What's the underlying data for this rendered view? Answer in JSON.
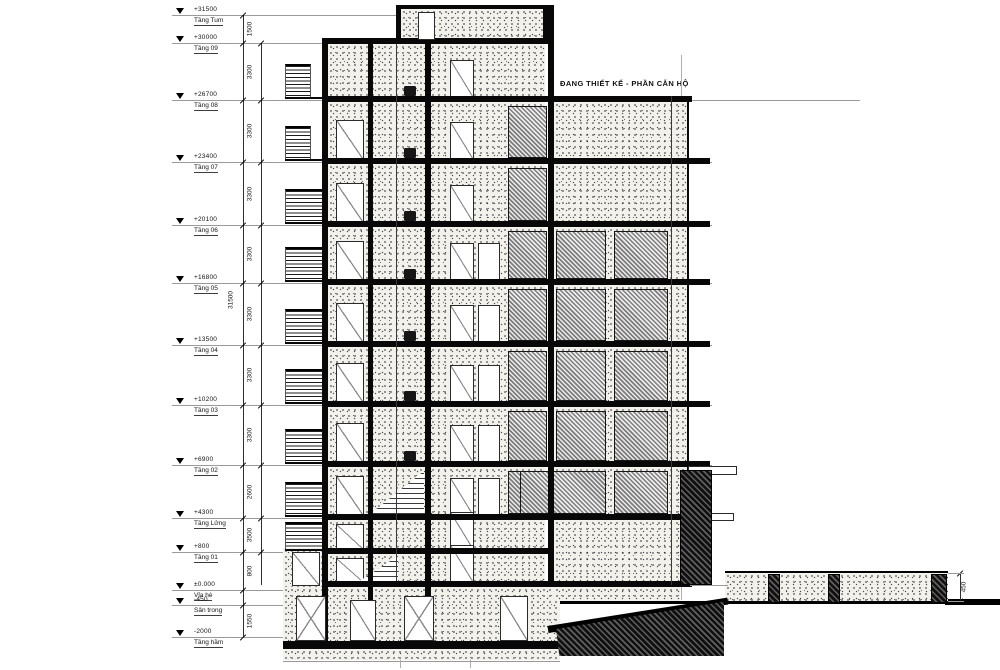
{
  "annotation": {
    "note": "ĐANG THIẾT KẾ - PHẦN CĂN HỘ"
  },
  "levels": [
    {
      "name": "Tầng Tum",
      "elev": "+31500"
    },
    {
      "name": "Tầng 09",
      "elev": "+30000"
    },
    {
      "name": "Tầng 08",
      "elev": "+26700"
    },
    {
      "name": "Tầng 07",
      "elev": "+23400"
    },
    {
      "name": "Tầng 06",
      "elev": "+20100"
    },
    {
      "name": "Tầng 05",
      "elev": "+16800"
    },
    {
      "name": "Tầng 04",
      "elev": "+13500"
    },
    {
      "name": "Tầng 03",
      "elev": "+10200"
    },
    {
      "name": "Tầng 02",
      "elev": "+6900"
    },
    {
      "name": "Tầng Lửng",
      "elev": "+4300"
    },
    {
      "name": "Tầng 01",
      "elev": "+800"
    },
    {
      "name": "Vỉa hè",
      "elev": "±0.000"
    },
    {
      "name": "Sân trong",
      "elev": "-450"
    },
    {
      "name": "Tầng hầm",
      "elev": "-2000"
    }
  ],
  "dimensions": {
    "floor_heights": [
      "1500",
      "3300",
      "3300",
      "3300",
      "3300",
      "3300",
      "3300",
      "3300",
      "2600",
      "3500",
      "800",
      "450",
      "1550"
    ],
    "overall": "31500",
    "right_wall_height": "450"
  },
  "colors": {
    "ink": "#0a0a0a",
    "line_gray": "#9a9a9a",
    "paper": "#ffffff"
  }
}
